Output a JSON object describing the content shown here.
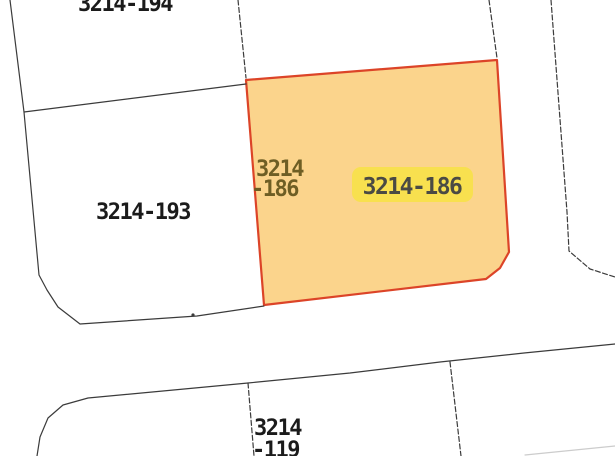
{
  "map_view": {
    "background": "#ffffff",
    "colors": {
      "boundary_line": "#3b3b3b",
      "faint_line": "#cccccc",
      "parcel_label": "#1b1b1b",
      "selected_fill": "#FBD48C",
      "selected_stroke": "#DC4428",
      "selected_inline_label": "#6E5E24",
      "tag_bg": "#F8E04F",
      "tag_text": "#4A4A44"
    },
    "parcels": {
      "p194": {
        "label": "3214-194"
      },
      "p193": {
        "label": "3214-193"
      },
      "p186": {
        "inline_label_line1": "3214",
        "inline_label_line2": "-186",
        "tag_label": "3214-186"
      },
      "p119": {
        "label_line1": "3214",
        "label_line2": "-119"
      }
    }
  }
}
